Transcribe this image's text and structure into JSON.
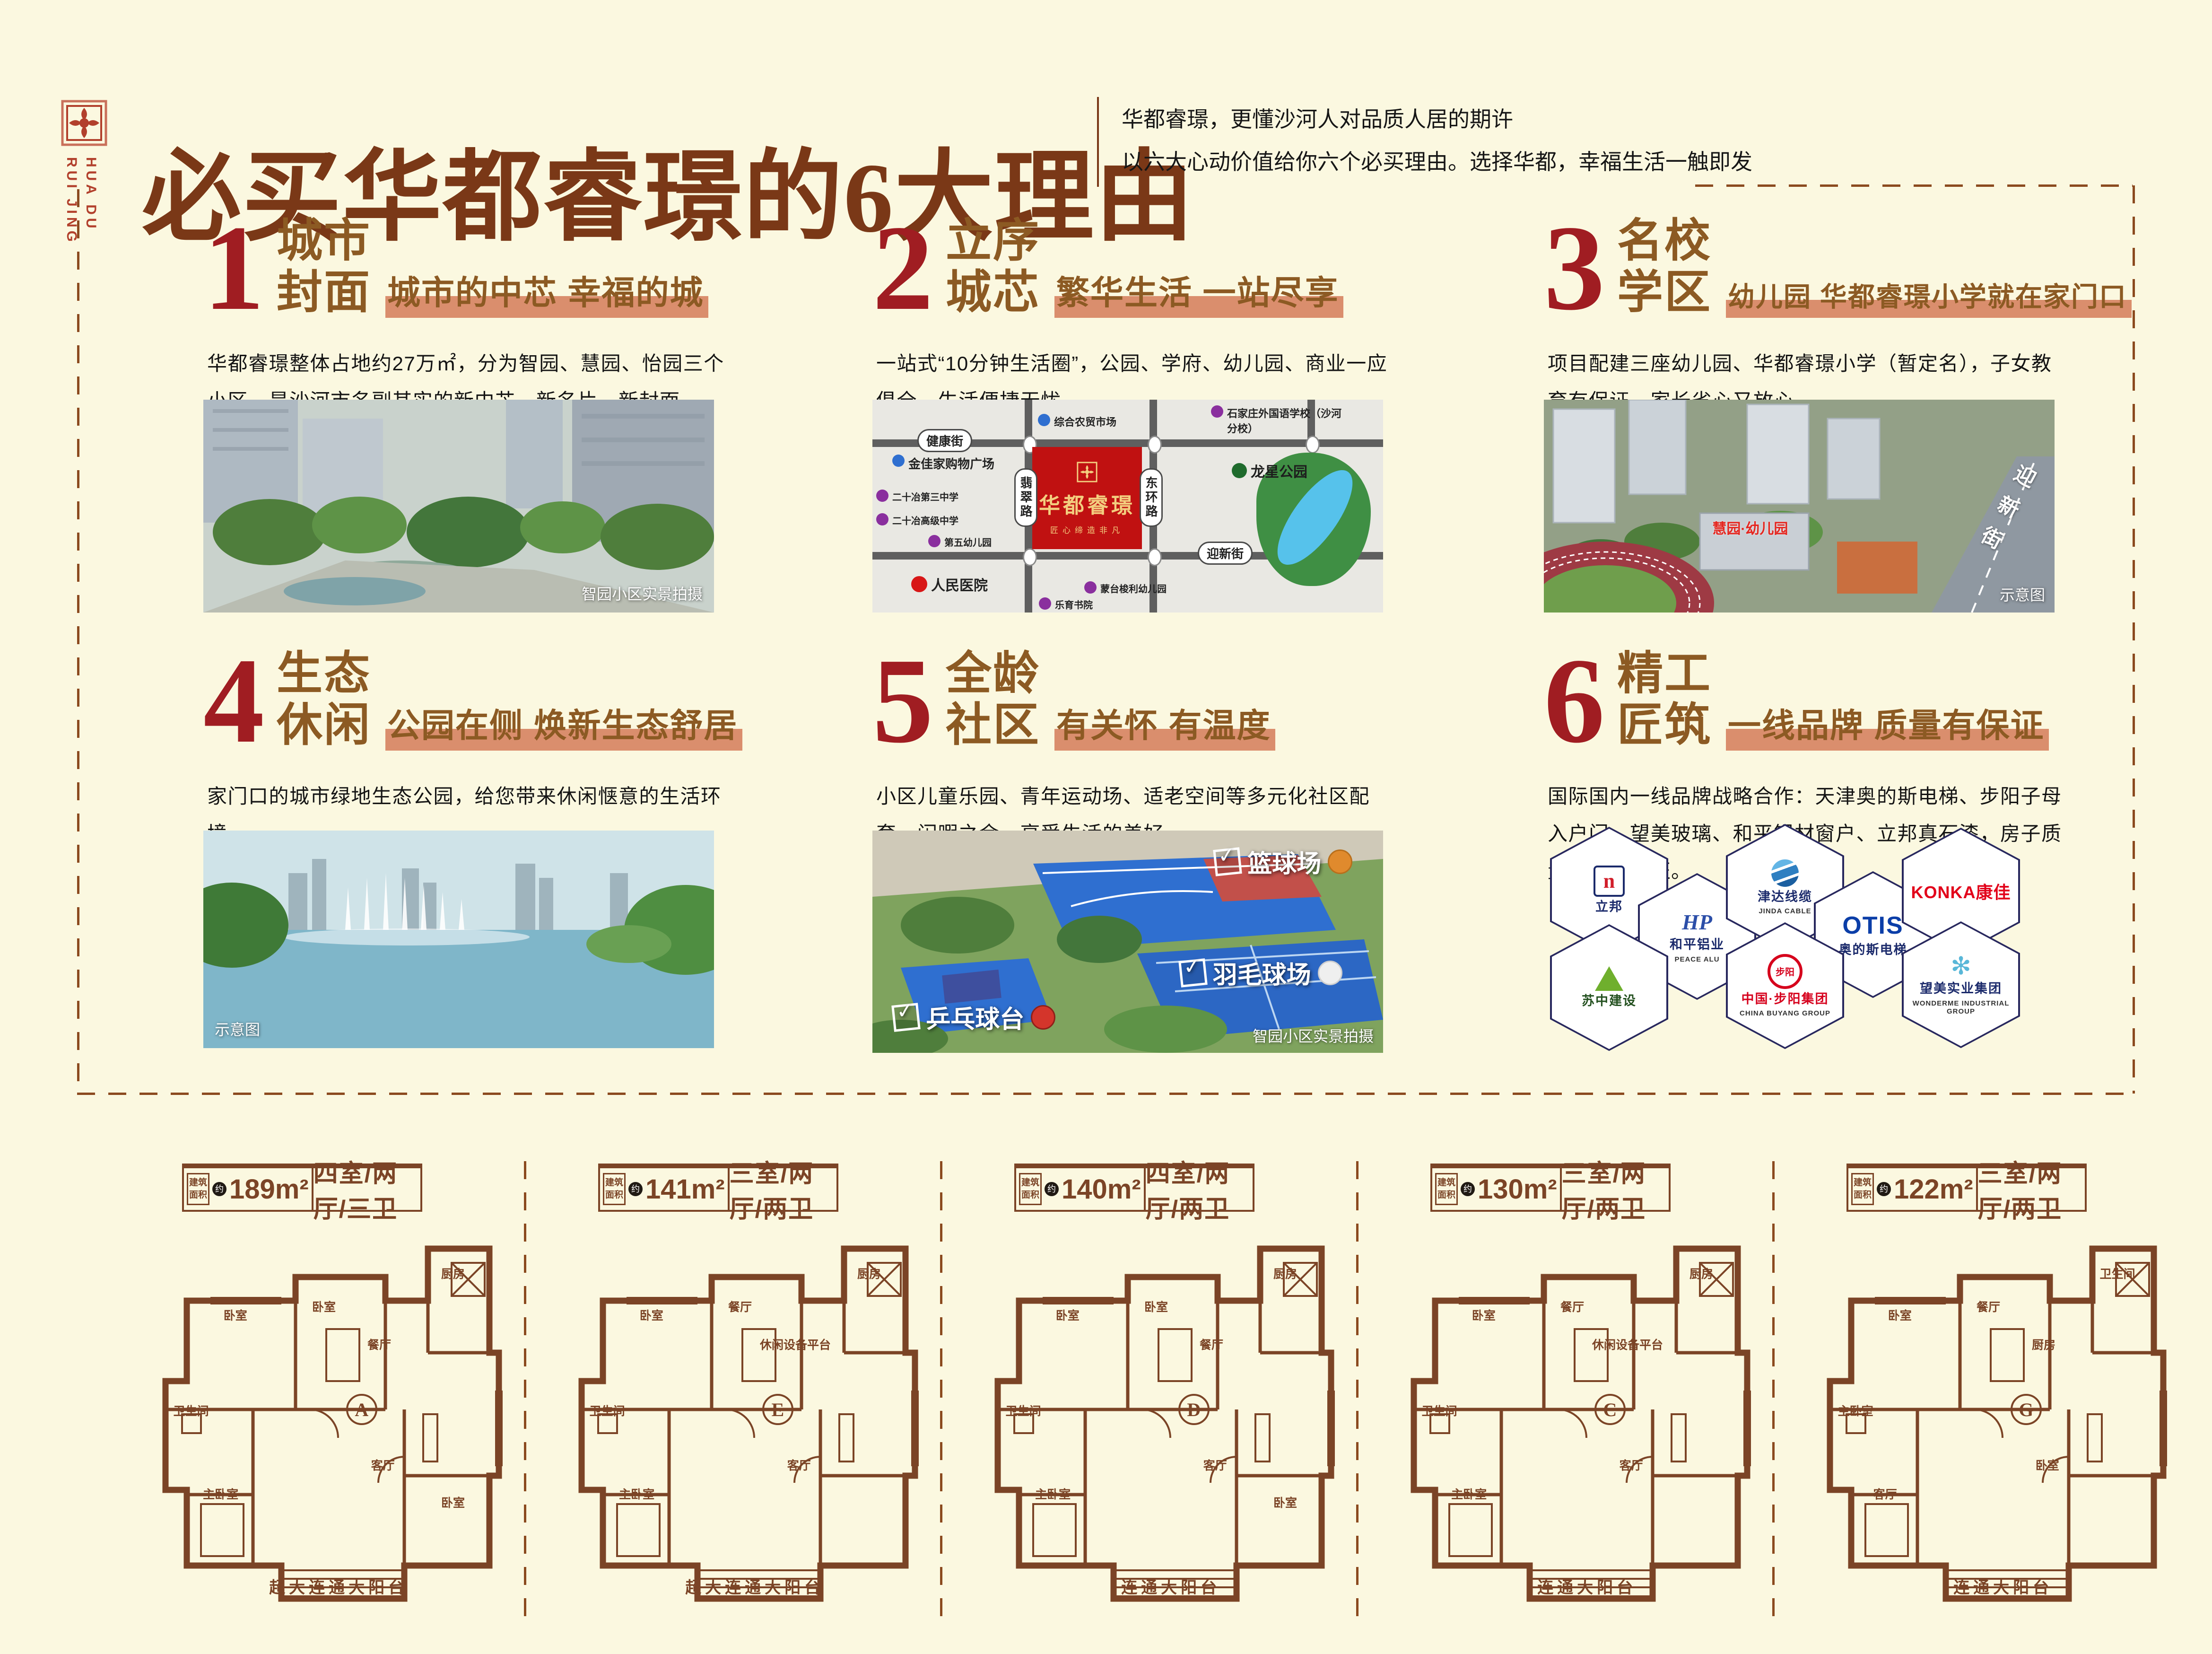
{
  "logo": {
    "en1": "HUA DU",
    "en2": "RUI JING"
  },
  "header": {
    "title": "必买华都睿璟的6大理由",
    "subtitle1": "华都睿璟，更懂沙河人对品质人居的期许",
    "subtitle2": "以六大心动价值给你六个必买理由。选择华都，幸福生活一触即发"
  },
  "colors": {
    "accent_red": "#A01D22",
    "brown": "#7A3817",
    "gold_brown": "#8C5A23",
    "highlight": "#D1704D",
    "plan_brown": "#7B4426"
  },
  "sections": [
    {
      "num": "1",
      "head1": "城市",
      "head2": "封面",
      "tagline": "城市的中芯 幸福的城",
      "body": "华都睿璟整体占地约27万㎡，分为智园、慧园、怡园三个小区，是沙河市名副其实的新中芯、新名片、新封面。",
      "caption": "智园小区实景拍摄"
    },
    {
      "num": "2",
      "head1": "立序",
      "head2": "城芯",
      "tagline": "繁华生活 一站尽享",
      "body": "一站式“10分钟生活圈”，公园、学府、幼儿园、商业一应俱全，生活便捷无忧。"
    },
    {
      "num": "3",
      "head1": "名校",
      "head2": "学区",
      "tagline": "幼儿园 华都睿璟小学就在家门口",
      "body": "项目配建三座幼儿园、华都睿璟小学（暂定名），子女教育有保证，家长省心又放心。",
      "caption": "示意图",
      "photo_label": "慧园·幼儿园",
      "road_label": "迎新街"
    },
    {
      "num": "4",
      "head1": "生态",
      "head2": "休闲",
      "tagline": "公园在侧 焕新生态舒居",
      "body": "家门口的城市绿地生态公园，给您带来休闲惬意的生活环境。",
      "caption": "示意图"
    },
    {
      "num": "5",
      "head1": "全龄",
      "head2": "社区",
      "tagline": "有关怀 有温度",
      "body": "小区儿童乐园、青年运动场、适老空间等多元化社区配套，闲暇之余，享受生活的美好。",
      "caption": "智园小区实景拍摄"
    },
    {
      "num": "6",
      "head1": "精工",
      "head2": "匠筑",
      "tagline": "一线品牌 质量有保证",
      "body": "国际国内一线品牌战略合作：天津奥的斯电梯、步阳子母入户门、望美玻璃、和平铝材窗户、立邦真石漆，房子质量无瑕有保证。"
    }
  ],
  "map": {
    "project_name": "华都睿璟",
    "project_slogan": "匠心缔造非凡",
    "street_north": "健康街",
    "street_west": "翡翠路",
    "street_east": "东环路",
    "street_south": "迎新街",
    "park": "龙星公园",
    "pois": [
      "综合农贸市场",
      "石家庄外国语学校（沙河分校）",
      "金佳家购物广场",
      "二十冶第三中学",
      "二十冶高级中学",
      "第五幼儿园",
      "人民医院",
      "蒙台梭利幼儿园",
      "乐育书院"
    ]
  },
  "photo5_labels": {
    "basketball": "篮球场",
    "badminton": "羽毛球场",
    "pingpong": "乒乓球台"
  },
  "brands": [
    {
      "name": "立邦",
      "sub": ""
    },
    {
      "name": "和平铝业",
      "sub": "PEACE ALU"
    },
    {
      "name": "津达线缆",
      "sub": "JINDA CABLE"
    },
    {
      "name": "OTIS",
      "sub": "奥的斯电梯"
    },
    {
      "name": "KONKA康佳",
      "sub": ""
    },
    {
      "name": "苏中建设",
      "sub": ""
    },
    {
      "name": "中国·步阳集团",
      "sub": "CHINA BUYANG GROUP"
    },
    {
      "name": "望美实业集团",
      "sub": "WONDERME INDUSTRIAL GROUP"
    }
  ],
  "plan_common": {
    "badge_l1": "建筑",
    "badge_l2": "面积",
    "approx": "约"
  },
  "floor_plans": [
    {
      "area": "189m²",
      "layout": "四室/两厅/三卫",
      "letter": "A",
      "balcony": "超大连通大阳台",
      "rooms": [
        "卧室",
        "卧室",
        "餐厅",
        "厨房",
        "卫生间",
        "主卧室",
        "客厅",
        "卧室"
      ]
    },
    {
      "area": "141m²",
      "layout": "三室/两厅/两卫",
      "letter": "E",
      "balcony": "超大连通大阳台",
      "rooms": [
        "卧室",
        "餐厅",
        "休闲设备平台",
        "厨房",
        "卫生间",
        "主卧室",
        "客厅"
      ]
    },
    {
      "area": "140m²",
      "layout": "四室/两厅/两卫",
      "letter": "D",
      "balcony": "连通大阳台",
      "rooms": [
        "卧室",
        "卧室",
        "餐厅",
        "厨房",
        "卫生间",
        "主卧室",
        "客厅",
        "卧室"
      ]
    },
    {
      "area": "130m²",
      "layout": "三室/两厅/两卫",
      "letter": "C",
      "balcony": "连通大阳台",
      "rooms": [
        "卧室",
        "餐厅",
        "休闲设备平台",
        "厨房",
        "卫生间",
        "主卧室",
        "客厅"
      ]
    },
    {
      "area": "122m²",
      "layout": "三室/两厅/两卫",
      "letter": "G",
      "balcony": "连通大阳台",
      "rooms": [
        "卧室",
        "餐厅",
        "厨房",
        "卫生间",
        "主卧室",
        "客厅",
        "卧室"
      ]
    }
  ]
}
